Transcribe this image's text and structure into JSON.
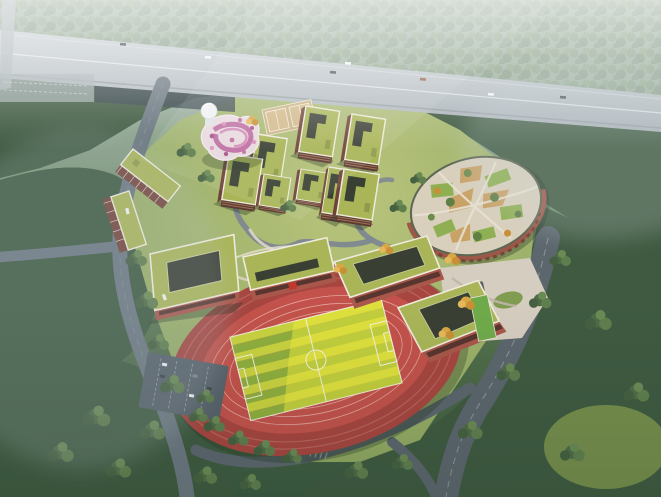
{
  "scene": {
    "kind": "aerial-architectural-rendering",
    "subject": "hillside-school-campus"
  },
  "landmarks": {
    "highway": "elevated-highway",
    "underpass": "highway-underpass",
    "stadium": "running-track-stadium",
    "field": "football-field",
    "garden": "elliptical-rooftop-farm",
    "arcade": "brick-arcade",
    "pink_building": "spiral-terraced-pavilion",
    "dome": "observatory-dome",
    "dorms": "green-roof-dormitory-cluster",
    "schools": "teaching-buildings",
    "v_building": "chevron-dormitory",
    "courts": "sports-courts",
    "pond": "courtyard-pool",
    "plaza": "entrance-plaza",
    "parking": "parking-lot",
    "roads": "perimeter-roads",
    "forest": "surrounding-forest",
    "meadow": "clearing-meadow"
  },
  "colors": {
    "haze_top": "#c3ced4",
    "haze_upper": "#9db2a4",
    "forest_mid": "#69855d",
    "forest_low": "#4c6947",
    "forest_deep": "#3a5840",
    "forest_base": "#3f5a41",
    "canopy_a": "#5e7b4e",
    "canopy_b": "#4a6544",
    "canopy_c": "#6f8d55",
    "canopy_d": "#557049",
    "highway_gray": "#b7bfc4",
    "underpass_dark": "#36444b",
    "road_main": "#5b666d",
    "road_hazy": "#6b7780",
    "road_campus": "#7e8890",
    "path_pale": "#ddd6c6",
    "lawn_light": "#b9c47c",
    "lawn_dark": "#8aa45e",
    "roof_green": "#a9b557",
    "roof_edge": "#efebdc",
    "skylight_dark": "#3a3f34",
    "facade_red": "#a8574a",
    "facade_dark": "#5d3b32",
    "stands_red": "#a74540",
    "track_red": "#c2524b",
    "track_line": "#eab3a9",
    "field_stripe_a": "#c9d23f",
    "field_stripe_b": "#8fae3e",
    "field_sun": "#f4ee3b",
    "field_line": "#f7f6ea",
    "pink_base": "#e8dadf",
    "pink_swirl": "#b9629b",
    "pink_light": "#cf86b4",
    "dome_white": "#eef1f3",
    "court_tan": "#c9b183",
    "garden_base": "#d8cfbc",
    "plot_green": "#8fb052",
    "plot_tan": "#c9a266",
    "arcade_brick": "#9b5848",
    "plaza_paving": "#d5cdbf",
    "water_teal": "#8fc0bd",
    "meadow_green": "#7f974f",
    "autumn_yellow": "#dca646",
    "car_white": "#f2f4f4",
    "car_dark": "#3a424a"
  }
}
